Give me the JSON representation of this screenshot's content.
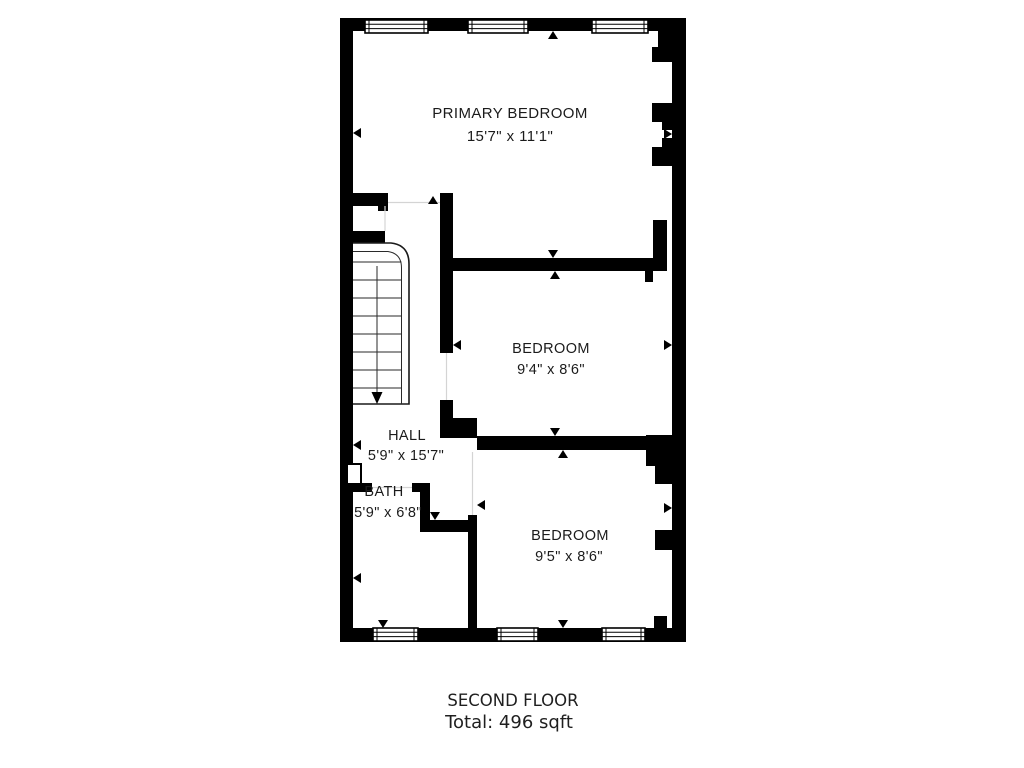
{
  "floorplan": {
    "rooms": [
      {
        "name": "PRIMARY BEDROOM",
        "dims": "15'7\" x 11'1\""
      },
      {
        "name": "BEDROOM",
        "dims": "9'4\" x 8'6\""
      },
      {
        "name": "HALL",
        "dims": "5'9\" x 15'7\""
      },
      {
        "name": "BATH",
        "dims": "5'9\" x 6'8\""
      },
      {
        "name": "BEDROOM",
        "dims": "9'5\" x 8'6\""
      }
    ],
    "caption": {
      "title": "SECOND FLOOR",
      "total": "Total: 496 sqft"
    },
    "colors": {
      "wall": "#000000",
      "text": "#1b1b1b",
      "background": "#ffffff"
    }
  }
}
